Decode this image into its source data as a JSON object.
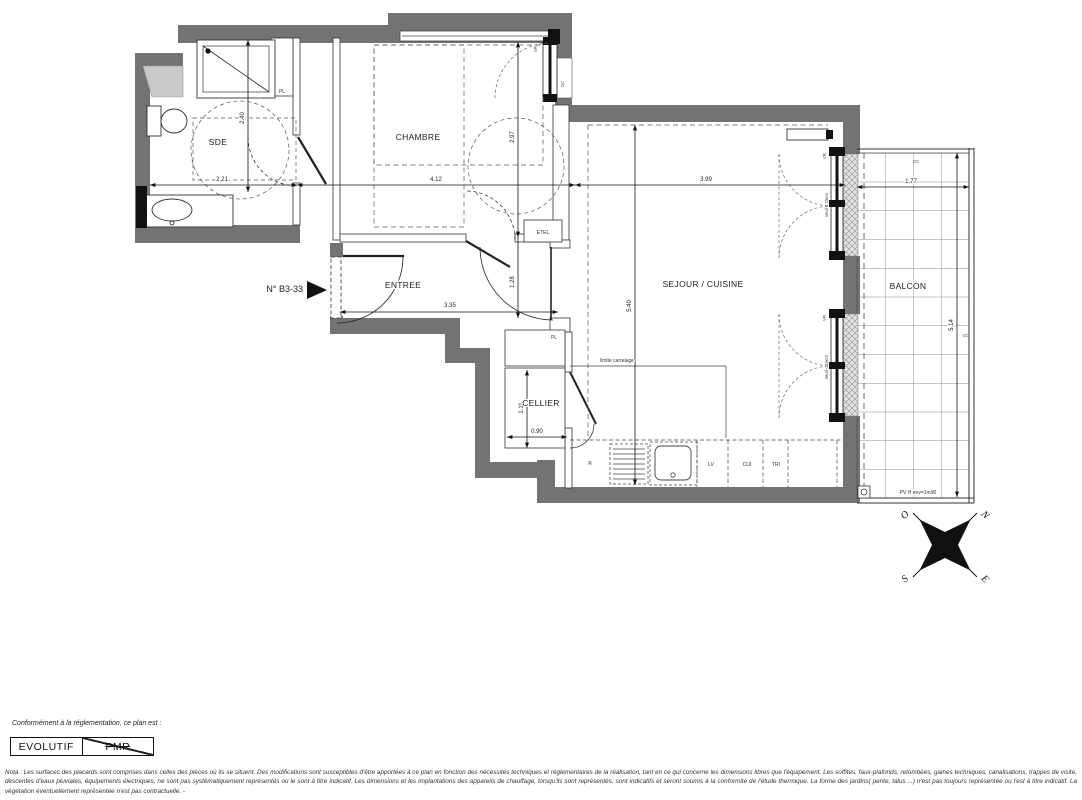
{
  "plan": {
    "number_label": "N° B3-33",
    "rooms": {
      "sde": "SDE",
      "chambre": "CHAMBRE",
      "entree": "ENTREE",
      "sejour_cuisine": "SEJOUR / CUISINE",
      "cellier": "CELLIER",
      "balcon": "BALCON"
    },
    "dims": {
      "sde_w": "2.21",
      "sde_h": "2.40",
      "chambre_w": "4.12",
      "chambre_h": "2.97",
      "entree_w": "3.35",
      "entree_h": "1.28",
      "sejour_w": "3.99",
      "sejour_h": "5.40",
      "cellier_w": "0.90",
      "cellier_h": "1.11",
      "balcon_w": "1.77",
      "balcon_h": "5.14"
    },
    "tags": {
      "pl_chambre": "PL",
      "pl_entree": "PL",
      "etel": "ETEL",
      "vr_chambre": "VR",
      "vr_sejour_top": "VR",
      "vr_sejour_bottom": "VR",
      "gc_chambre": "GC",
      "gc_balcon_top": "GC",
      "gc_balcon_right": "GC",
      "seuil_top": "seuil < 15cm",
      "seuil_bottom": "seuil < 15cm",
      "limite_carrelage": "limite carrelage",
      "pare_vue": "PV H env=1m90",
      "kitchen_r": "R",
      "kitchen_lv": "LV",
      "kitchen_cui": "CUI",
      "kitchen_tri": "TRI"
    }
  },
  "compass": {
    "north": "N",
    "east": "E",
    "south": "S",
    "west": "O"
  },
  "footer": {
    "caption": "Conformément à la réglementation, ce plan est :",
    "evolutif_label": "EVOLUTIF",
    "pmr_label": "PMR",
    "nota": "Nota : Les surfaces des placards sont comprises dans celles des pièces où ils se situent. Des modifications sont susceptibles d'être apportées à ce plan en fonction des nécessités techniques et réglementaires de la réalisation, tant en ce qui concerne les dimensions libres que l'équipement.  Les soffites, faux-plafonds, retombées, gaines techniques, canalisations, trappes de visite, descentes d'eaux pluviales, équipements électriques, ne sont pas systématiquement représentés ou le sont à titre indicatif. Les dimensions et les implantations des appareils de chauffage, lorsqu'ils sont représentés, sont indicatifs et seront soumis à la conformité de l'étude thermique. La forme des jardins( pente, talus ...) n'est pas toujours représentée ou l'est à titre indicatif. La végétation éventuellement représentée n'est pas contractuelle. -"
  },
  "colors": {
    "wall": "#737373",
    "line": "#222222",
    "hatch_bg": "#e3e3e3",
    "paper": "#ffffff"
  }
}
